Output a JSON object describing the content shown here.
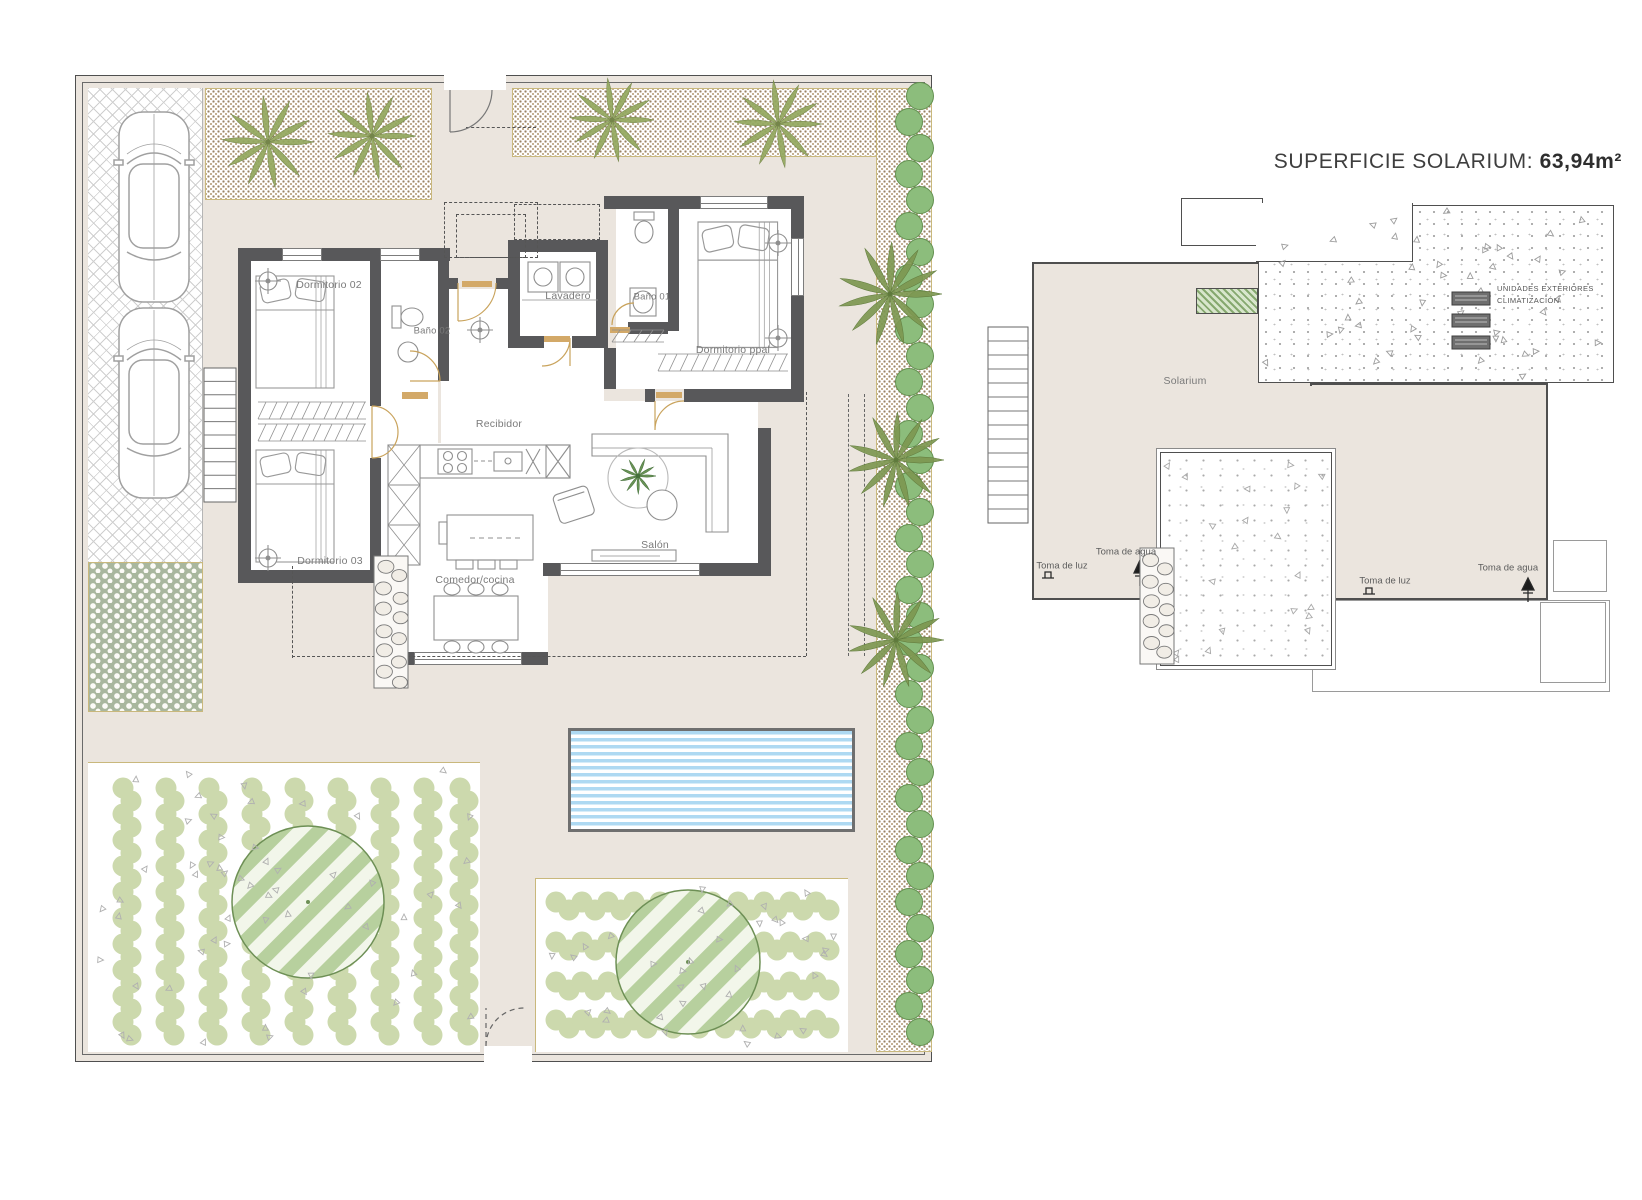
{
  "title": {
    "label": "SUPERFICIE SOLARIUM: ",
    "value": "63,94m²"
  },
  "ground_floor": {
    "rooms": {
      "dormitorio02": "Dormitorio 02",
      "bano02": "Baño 02",
      "lavadero": "Lavadero",
      "bano01": "Baño 01",
      "dormitorio_ppal": "Dormitorio ppal",
      "recibidor": "Recibidor",
      "dormitorio03": "Dormitorio 03",
      "comedor_cocina": "Comedor/cocina",
      "salon": "Salón"
    }
  },
  "solarium_plan": {
    "area_label": "Solarium",
    "ac_label": [
      "UNIDADES EXTERIORES",
      "CLIMATIZACIÓN"
    ],
    "utilities": {
      "luz": "Toma de luz",
      "agua": "Toma de agua"
    }
  },
  "colors": {
    "beige": "#ebe5de",
    "wall": "#58585a",
    "tan": "#c9b87c",
    "door": "#c9a35c",
    "hedge": "#8cbd7c",
    "hedgedark": "#639050",
    "shrub": "#ccd9ad",
    "fern": "#93a75d",
    "palm": "#7d9750",
    "treestroke": "#6d8f55",
    "treefill": "#b7d09e",
    "pool": "#aed9f2",
    "linegray": "#8f8f8f",
    "pebble": "#a9b79e"
  }
}
